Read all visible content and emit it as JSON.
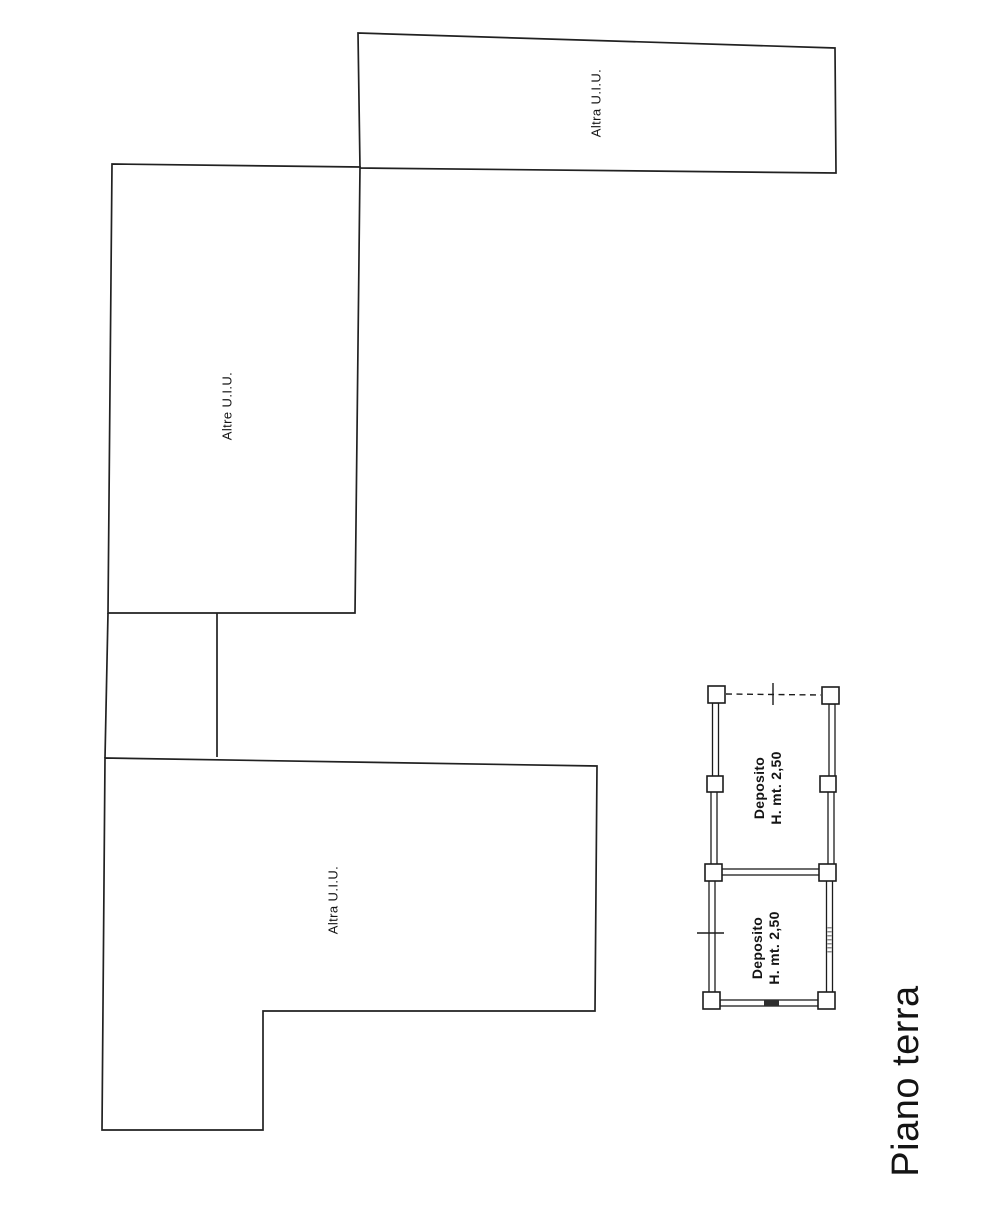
{
  "page": {
    "background_color": "#ffffff",
    "line_color": "#212121",
    "text_color": "#141414"
  },
  "plan": {
    "floor_title": "Piano terra",
    "units": [
      {
        "position": "top",
        "label": "Altra U.I.U."
      },
      {
        "position": "middle",
        "label": "Altre U.I.U."
      },
      {
        "position": "bottom",
        "label": "Altra U.I.U."
      }
    ],
    "deposito_rooms": [
      {
        "position": "upper",
        "name": "Deposito",
        "height_note": "H. mt. 2,50"
      },
      {
        "position": "lower",
        "name": "Deposito",
        "height_note": "H. mt. 2,50"
      }
    ]
  }
}
